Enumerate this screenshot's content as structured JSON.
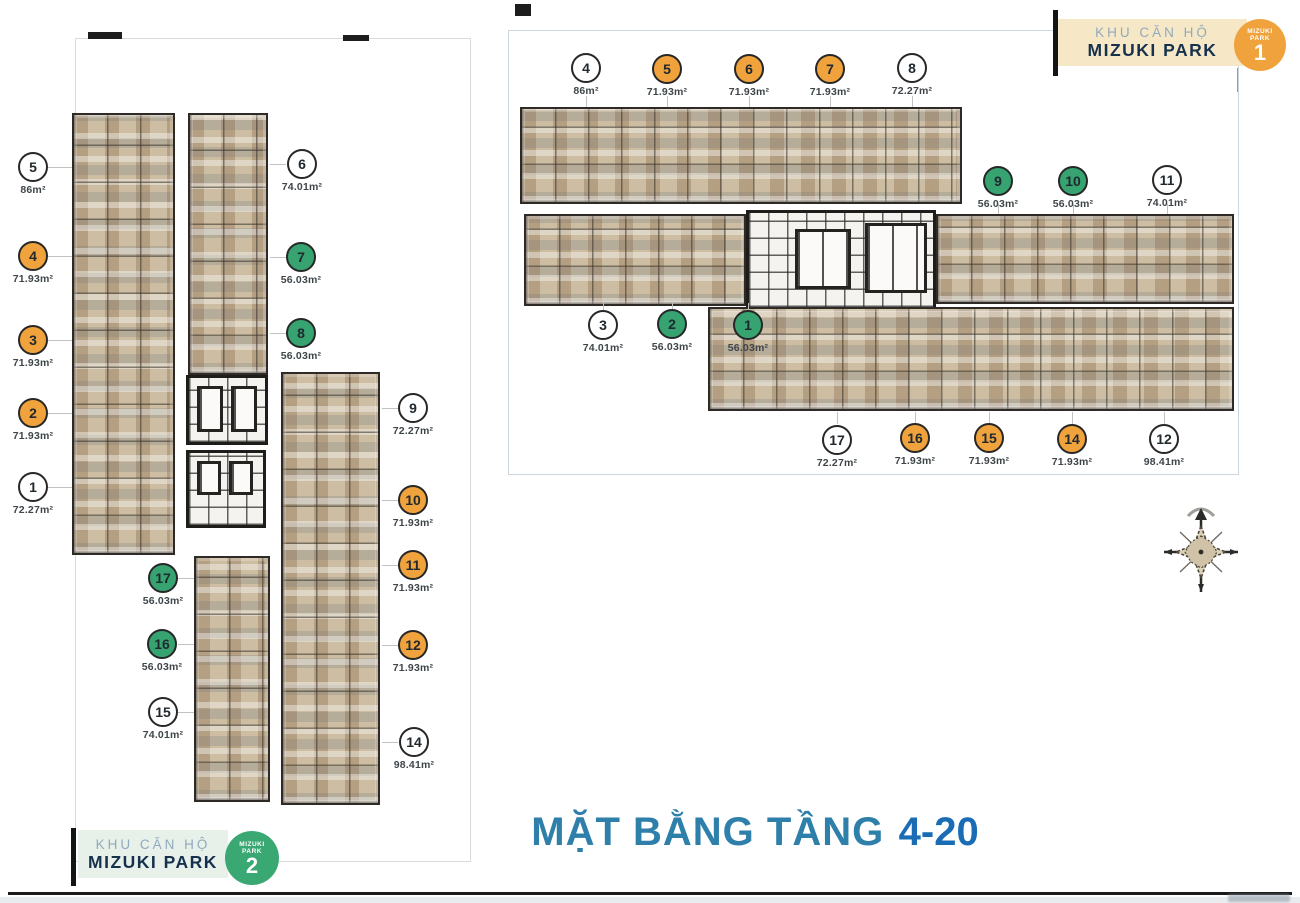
{
  "title": {
    "prefix": "MẶT BẰNG TẦNG",
    "floors": "4-20"
  },
  "legend": {
    "project_label": "KHU CĂN HỘ",
    "project_name": "MIZUKI PARK",
    "badge1": {
      "line1": "MIZUKI",
      "line2": "PARK",
      "number": "1"
    },
    "badge2": {
      "line1": "MIZUKI",
      "line2": "PARK",
      "number": "2"
    }
  },
  "colors": {
    "orange_unit": "#f0a23c",
    "green_unit": "#36a370",
    "white_unit": "#ffffff",
    "title_blue": "#2e7fa9",
    "accent_blue": "#1a6cb5",
    "badge1_bg": "#f6e8c6",
    "badge2_bg": "#e7f1ea"
  },
  "mizuki_park_2": {
    "name": "MIZUKI PARK 2",
    "markers": [
      {
        "num": "5",
        "area": "86m²",
        "type": "white"
      },
      {
        "num": "4",
        "area": "71.93m²",
        "type": "orange"
      },
      {
        "num": "3",
        "area": "71.93m²",
        "type": "orange"
      },
      {
        "num": "2",
        "area": "71.93m²",
        "type": "orange"
      },
      {
        "num": "1",
        "area": "72.27m²",
        "type": "white"
      },
      {
        "num": "6",
        "area": "74.01m²",
        "type": "white"
      },
      {
        "num": "7",
        "area": "56.03m²",
        "type": "green"
      },
      {
        "num": "8",
        "area": "56.03m²",
        "type": "green"
      },
      {
        "num": "9",
        "area": "72.27m²",
        "type": "white"
      },
      {
        "num": "10",
        "area": "71.93m²",
        "type": "orange"
      },
      {
        "num": "11",
        "area": "71.93m²",
        "type": "orange"
      },
      {
        "num": "12",
        "area": "71.93m²",
        "type": "orange"
      },
      {
        "num": "14",
        "area": "98.41m²",
        "type": "white"
      },
      {
        "num": "17",
        "area": "56.03m²",
        "type": "green"
      },
      {
        "num": "16",
        "area": "56.03m²",
        "type": "green"
      },
      {
        "num": "15",
        "area": "74.01m²",
        "type": "white"
      }
    ]
  },
  "mizuki_park_1": {
    "name": "MIZUKI PARK 1",
    "markers": [
      {
        "num": "4",
        "area": "86m²",
        "type": "white"
      },
      {
        "num": "5",
        "area": "71.93m²",
        "type": "orange"
      },
      {
        "num": "6",
        "area": "71.93m²",
        "type": "orange"
      },
      {
        "num": "7",
        "area": "71.93m²",
        "type": "orange"
      },
      {
        "num": "8",
        "area": "72.27m²",
        "type": "white"
      },
      {
        "num": "9",
        "area": "56.03m²",
        "type": "green"
      },
      {
        "num": "10",
        "area": "56.03m²",
        "type": "green"
      },
      {
        "num": "11",
        "area": "74.01m²",
        "type": "white"
      },
      {
        "num": "3",
        "area": "74.01m²",
        "type": "white"
      },
      {
        "num": "2",
        "area": "56.03m²",
        "type": "green"
      },
      {
        "num": "1",
        "area": "56.03m²",
        "type": "green"
      },
      {
        "num": "17",
        "area": "72.27m²",
        "type": "white"
      },
      {
        "num": "16",
        "area": "71.93m²",
        "type": "orange"
      },
      {
        "num": "15",
        "area": "71.93m²",
        "type": "orange"
      },
      {
        "num": "14",
        "area": "71.93m²",
        "type": "orange"
      },
      {
        "num": "12",
        "area": "98.41m²",
        "type": "white"
      }
    ]
  }
}
